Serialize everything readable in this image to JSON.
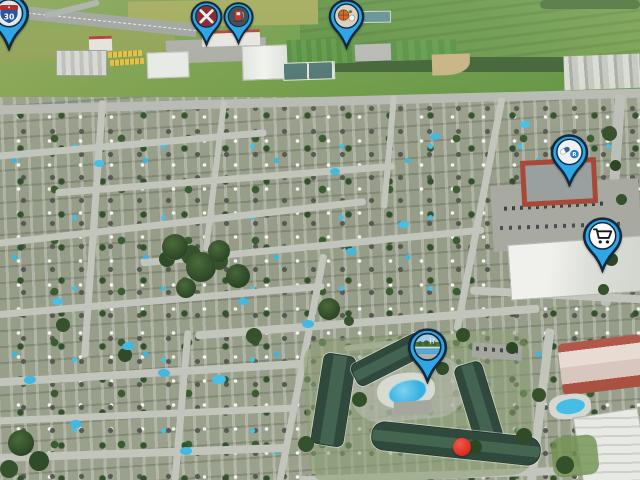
{
  "map": {
    "scene": "aerial-oblique-suburb",
    "marker_blue": "#2fa6e5",
    "marker_outline": "#11293c",
    "property_dot_red": "#e2372b"
  },
  "pins": [
    {
      "name": "highway-exit",
      "icon": "highway-shield-icon",
      "shield_number": "30"
    },
    {
      "name": "restaurant",
      "icon": "crossed-utensils-icon"
    },
    {
      "name": "gas-station",
      "icon": "fuel-pump-icon"
    },
    {
      "name": "sports-centre",
      "icon": "basketball-icon"
    },
    {
      "name": "pharmacy",
      "icon": "pill-rx-icon",
      "badge_letter": "R"
    },
    {
      "name": "grocery-store",
      "icon": "shopping-cart-icon"
    },
    {
      "name": "pool-park",
      "icon": "pool-scene-icon"
    },
    {
      "name": "subject-property",
      "icon": "red-dot-marker"
    }
  ]
}
